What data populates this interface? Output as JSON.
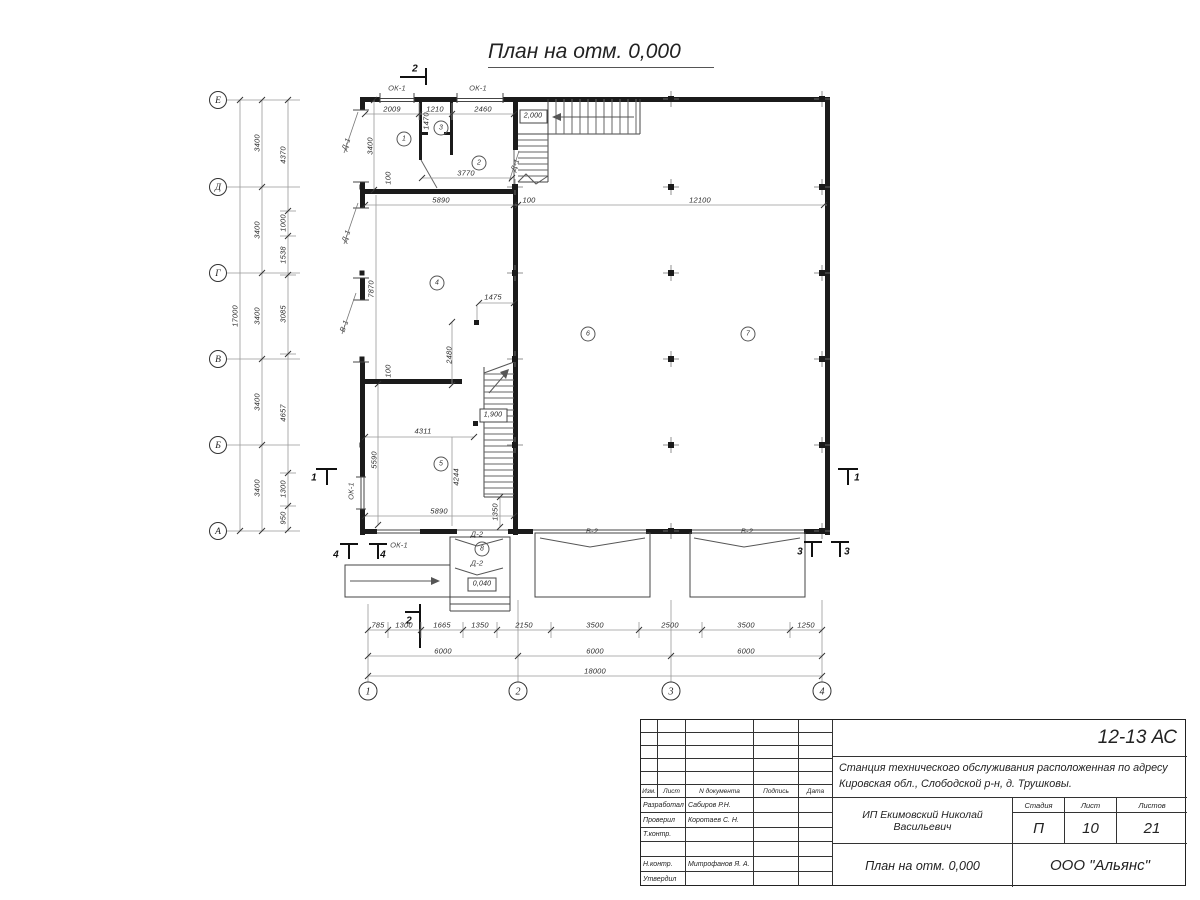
{
  "plan": {
    "title": "План на отм. 0,000",
    "rooms": [
      {
        "t": "1",
        "x": 404,
        "y": 139
      },
      {
        "t": "2",
        "x": 479,
        "y": 163
      },
      {
        "t": "3",
        "x": 441,
        "y": 128
      },
      {
        "t": "4",
        "x": 437,
        "y": 283
      },
      {
        "t": "5",
        "x": 441,
        "y": 464
      },
      {
        "t": "6",
        "x": 588,
        "y": 334
      },
      {
        "t": "7",
        "x": 748,
        "y": 334
      },
      {
        "t": "8",
        "x": 482,
        "y": 549
      }
    ],
    "dim_labels": [
      {
        "t": "2009",
        "x": 392,
        "y": 109
      },
      {
        "t": "1210",
        "x": 435,
        "y": 109
      },
      {
        "t": "2460",
        "x": 483,
        "y": 109
      },
      {
        "t": "1470",
        "x": 426,
        "y": 121,
        "r": -90
      },
      {
        "t": "3400",
        "x": 370,
        "y": 146,
        "r": -90
      },
      {
        "t": "100",
        "x": 388,
        "y": 178,
        "r": -90
      },
      {
        "t": "3770",
        "x": 466,
        "y": 173
      },
      {
        "t": "5890",
        "x": 441,
        "y": 200
      },
      {
        "t": "100",
        "x": 529,
        "y": 200
      },
      {
        "t": "12100",
        "x": 700,
        "y": 200
      },
      {
        "t": "7870",
        "x": 371,
        "y": 289,
        "r": -90
      },
      {
        "t": "100",
        "x": 388,
        "y": 371,
        "r": -90
      },
      {
        "t": "1475",
        "x": 493,
        "y": 297
      },
      {
        "t": "2480",
        "x": 449,
        "y": 355,
        "r": -90
      },
      {
        "t": "4311",
        "x": 423,
        "y": 431
      },
      {
        "t": "5590",
        "x": 374,
        "y": 460,
        "r": -90
      },
      {
        "t": "4244",
        "x": 456,
        "y": 477,
        "r": -90
      },
      {
        "t": "5890",
        "x": 439,
        "y": 511
      },
      {
        "t": "1350",
        "x": 495,
        "y": 512,
        "r": -90
      }
    ],
    "left_dims": [
      {
        "t": "17000",
        "x": 235,
        "y": 316,
        "r": -90
      },
      {
        "t": "3400",
        "x": 257,
        "y": 143,
        "r": -90
      },
      {
        "t": "3400",
        "x": 257,
        "y": 230,
        "r": -90
      },
      {
        "t": "3400",
        "x": 257,
        "y": 316,
        "r": -90
      },
      {
        "t": "3400",
        "x": 257,
        "y": 402,
        "r": -90
      },
      {
        "t": "3400",
        "x": 257,
        "y": 488,
        "r": -90
      },
      {
        "t": "4370",
        "x": 283,
        "y": 155,
        "r": -90
      },
      {
        "t": "1000",
        "x": 283,
        "y": 223,
        "r": -90
      },
      {
        "t": "1538",
        "x": 283,
        "y": 255,
        "r": -90
      },
      {
        "t": "3085",
        "x": 283,
        "y": 314,
        "r": -90
      },
      {
        "t": "4657",
        "x": 283,
        "y": 413,
        "r": -90
      },
      {
        "t": "1300",
        "x": 283,
        "y": 489,
        "r": -90
      },
      {
        "t": "950",
        "x": 283,
        "y": 518,
        "r": -90
      }
    ],
    "bottom_dims": [
      {
        "t": "785",
        "x": 378,
        "y": 625
      },
      {
        "t": "1300",
        "x": 404,
        "y": 625
      },
      {
        "t": "1665",
        "x": 442,
        "y": 625
      },
      {
        "t": "1350",
        "x": 480,
        "y": 625
      },
      {
        "t": "2150",
        "x": 524,
        "y": 625
      },
      {
        "t": "3500",
        "x": 595,
        "y": 625
      },
      {
        "t": "2500",
        "x": 670,
        "y": 625
      },
      {
        "t": "3500",
        "x": 746,
        "y": 625
      },
      {
        "t": "1250",
        "x": 806,
        "y": 625
      },
      {
        "t": "6000",
        "x": 443,
        "y": 651
      },
      {
        "t": "6000",
        "x": 595,
        "y": 651
      },
      {
        "t": "6000",
        "x": 746,
        "y": 651
      },
      {
        "t": "18000",
        "x": 595,
        "y": 671
      }
    ],
    "axis_letters": [
      {
        "t": "Е",
        "x": 218,
        "y": 100
      },
      {
        "t": "Д",
        "x": 218,
        "y": 187
      },
      {
        "t": "Г",
        "x": 218,
        "y": 273
      },
      {
        "t": "В",
        "x": 218,
        "y": 359
      },
      {
        "t": "Б",
        "x": 218,
        "y": 445
      },
      {
        "t": "А",
        "x": 218,
        "y": 531
      }
    ],
    "axis_numbers": [
      {
        "t": "1",
        "x": 368,
        "y": 691
      },
      {
        "t": "2",
        "x": 518,
        "y": 691
      },
      {
        "t": "3",
        "x": 671,
        "y": 691
      },
      {
        "t": "4",
        "x": 822,
        "y": 691
      }
    ],
    "opening_labels": [
      {
        "t": "ОК-1",
        "x": 397,
        "y": 88
      },
      {
        "t": "ОК-1",
        "x": 478,
        "y": 88
      },
      {
        "t": "ОК-1",
        "x": 351,
        "y": 491,
        "r": -90
      },
      {
        "t": "ОК-1",
        "x": 399,
        "y": 545
      },
      {
        "t": "Д-1",
        "x": 346,
        "y": 144,
        "r": -70
      },
      {
        "t": "Д-1",
        "x": 346,
        "y": 236,
        "r": -70
      },
      {
        "t": "В-1",
        "x": 344,
        "y": 326,
        "r": -70
      },
      {
        "t": "Д-1",
        "x": 515,
        "y": 165,
        "r": -70
      },
      {
        "t": "Д-2",
        "x": 477,
        "y": 534
      },
      {
        "t": "Д-2",
        "x": 477,
        "y": 563
      },
      {
        "t": "В-2",
        "x": 592,
        "y": 531
      },
      {
        "t": "В-2",
        "x": 747,
        "y": 531
      }
    ],
    "section_labels": [
      {
        "t": "2",
        "x": 415,
        "y": 69
      },
      {
        "t": "2",
        "x": 409,
        "y": 621
      },
      {
        "t": "1",
        "x": 314,
        "y": 478
      },
      {
        "t": "1",
        "x": 857,
        "y": 478
      },
      {
        "t": "4",
        "x": 336,
        "y": 555
      },
      {
        "t": "4",
        "x": 383,
        "y": 555
      },
      {
        "t": "3",
        "x": 800,
        "y": 552
      },
      {
        "t": "3",
        "x": 847,
        "y": 552
      }
    ],
    "elevation_marks": [
      {
        "t": "2,000",
        "x": 533,
        "y": 116
      },
      {
        "t": "1,900",
        "x": 493,
        "y": 415
      },
      {
        "t": "0,040",
        "x": 482,
        "y": 584
      }
    ]
  },
  "titleblock": {
    "code": "12-13 АС",
    "project_line1": "Станция технического обслуживания расположенная по адресу",
    "project_line2": "Кировская обл., Слободской р-н, д. Трушковы.",
    "client": "ИП Екимовский Николай Васильевич",
    "sheet_title": "План на отм. 0,000",
    "company": "ООО \"Альянс\"",
    "stage_label": "Стадия",
    "sheet_label": "Лист",
    "sheets_label": "Листов",
    "stage": "П",
    "sheet": "10",
    "sheets": "21",
    "columns": [
      "Изм.",
      "Лист",
      "N документа",
      "Подпись",
      "Дата"
    ],
    "roles": [
      {
        "role": "Разработал",
        "name": "Сабиров Р.Н."
      },
      {
        "role": "Проверил",
        "name": "Коротаев С. Н."
      },
      {
        "role": "Т.контр.",
        "name": ""
      },
      {
        "role": "",
        "name": ""
      },
      {
        "role": "Н.контр.",
        "name": "Митрофанов Я. А."
      },
      {
        "role": "Утвердил",
        "name": ""
      }
    ]
  }
}
